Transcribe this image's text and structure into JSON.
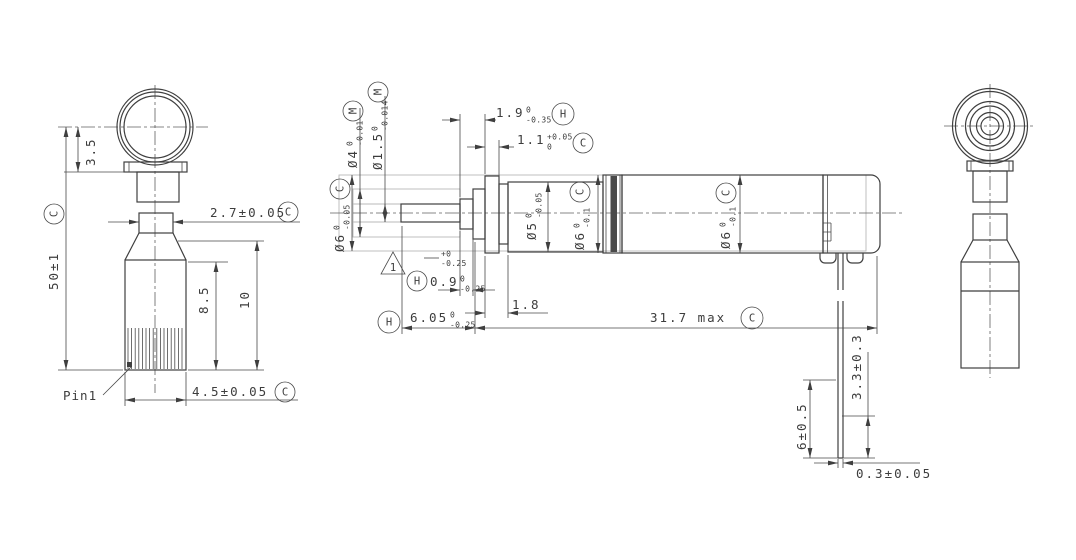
{
  "left_view": {
    "dim_3_5": {
      "value": "3.5"
    },
    "dim_50": {
      "value": "50±1",
      "flag": "C"
    },
    "dim_2_7": {
      "value": "2.7±0.05",
      "flag": "C"
    },
    "dim_8_5": {
      "value": "8.5"
    },
    "dim_10": {
      "value": "10"
    },
    "dim_4_5": {
      "value": "4.5±0.05",
      "flag": "C"
    },
    "pin_label": "Pin1"
  },
  "middle_view": {
    "dia6_envelope": {
      "value": "Ø6",
      "sup": "0",
      "sub": "-0.05",
      "flag": "C"
    },
    "dia4": {
      "value": "Ø4",
      "sup": "0",
      "sub": "-0.01",
      "flag": "M"
    },
    "dia1_5": {
      "value": "Ø1.5",
      "sup": "0",
      "sub": "-0.014",
      "flag": "M"
    },
    "dim_1_9": {
      "value": "1.9",
      "sup": "0",
      "sub": "-0.35",
      "flag": "H"
    },
    "dim_1_1": {
      "value": "1.1",
      "sup": "+0.05",
      "sub": "0",
      "flag": "C"
    },
    "dia5": {
      "value": "Ø5",
      "sup": "0",
      "sub": "-0.05"
    },
    "dia6_mid": {
      "value": "Ø6",
      "sup": "0",
      "sub": "-0.1",
      "flag": "C"
    },
    "dia6_right": {
      "value": "Ø6",
      "sup": "0",
      "sub": "-0.1",
      "flag": "C"
    },
    "rev_triangle": {
      "value": "1"
    },
    "float_tol": {
      "sup": "+0",
      "sub": "-0.25"
    },
    "dim_0_9": {
      "value": "0.9",
      "sup": "0",
      "sub": "-0.25",
      "flag": "H"
    },
    "dim_1_8": {
      "value": "1.8"
    },
    "dim_6_05": {
      "value": "6.05",
      "sup": "0",
      "sub": "-0.25",
      "flag": "H"
    },
    "dim_31_7": {
      "value": "31.7 max",
      "flag": "C"
    },
    "dim_6": {
      "value": "6±0.5"
    },
    "dim_3_3": {
      "value": "3.3±0.3"
    },
    "dim_0_3": {
      "value": "0.3±0.05"
    }
  }
}
